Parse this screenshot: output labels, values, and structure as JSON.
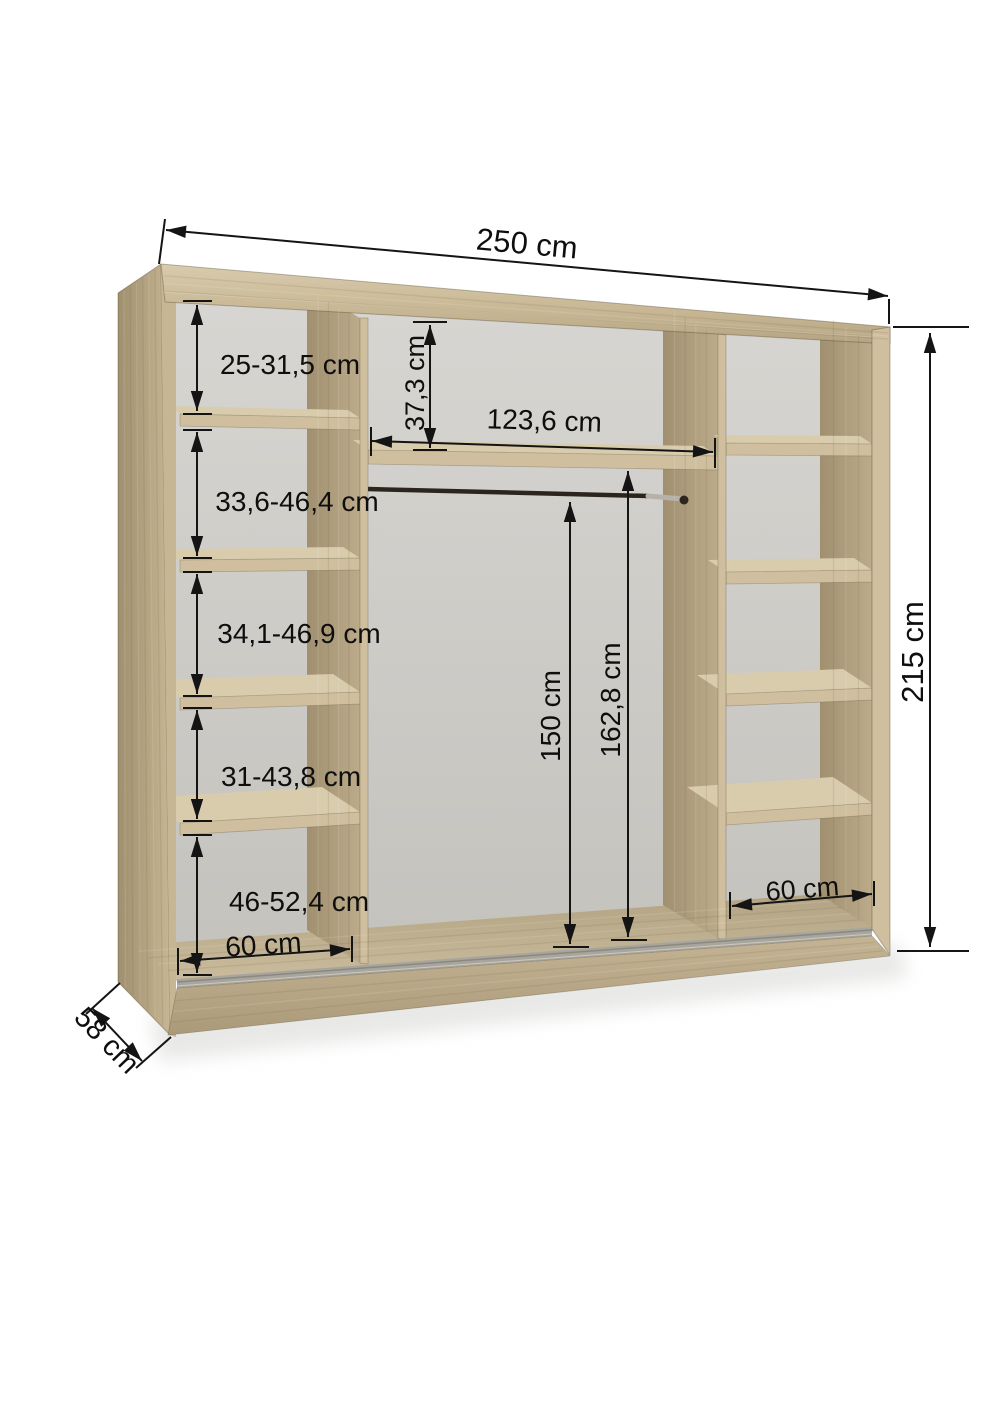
{
  "diagram": {
    "type": "wardrobe-interior-dimension-diagram",
    "dimensions": {
      "overall_width": "250 cm",
      "overall_height": "215 cm",
      "overall_depth": "58 cm",
      "left_compartments": [
        "25-31,5 cm",
        "33,6-46,4 cm",
        "34,1-46,9 cm",
        "31-43,8 cm",
        "46-52,4 cm"
      ],
      "left_section_width": "60 cm",
      "middle_top_gap": "37,3 cm",
      "middle_section_width": "123,6 cm",
      "hanging_rod_height": "150 cm",
      "middle_opening_height": "162,8 cm",
      "right_section_width": "60 cm"
    },
    "colors": {
      "wood": "#c7b693",
      "wood_light": "#d8ccad",
      "wood_dark": "#a1906f",
      "wood_edge": "#cfbf9e",
      "back_panel": "#d8d6d2",
      "back_panel_dark": "#c3c1bc",
      "floor": "#c9bb9b",
      "track": "#a8a59d",
      "rod": "#2b251e",
      "rod_metal": "#b6b2a9",
      "dimension": "#141414",
      "background": "#ffffff"
    }
  }
}
